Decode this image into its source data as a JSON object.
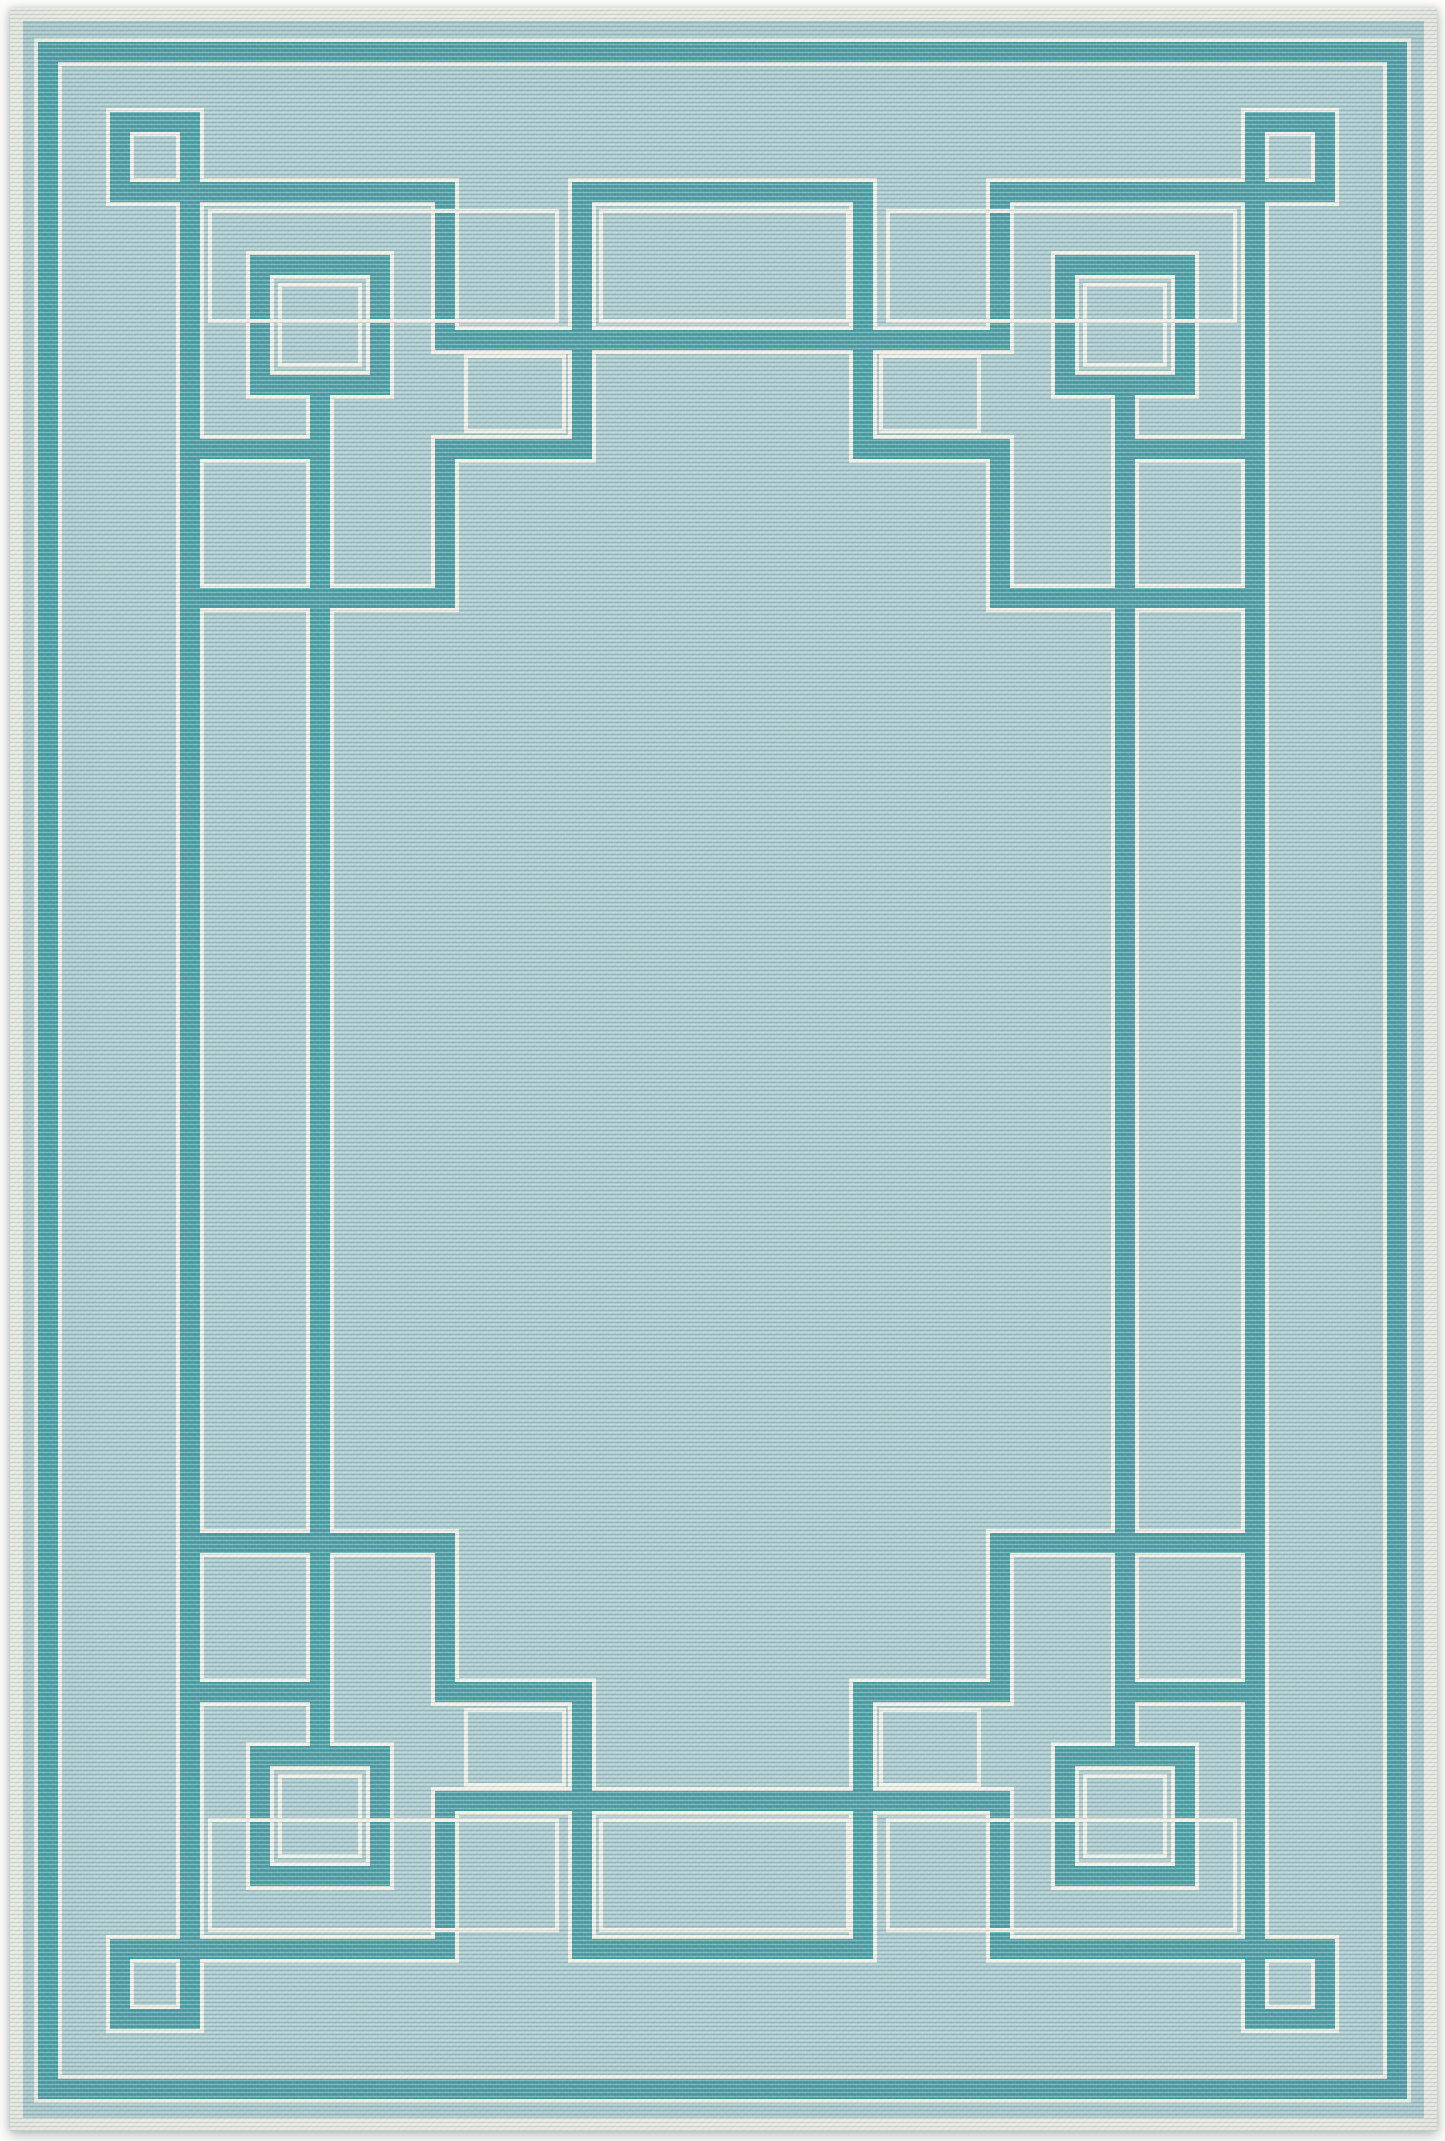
{
  "caption": "Product photograph of a portrait-oriented flat-weave area rug: light aqua ribbed field with a teal Art Deco interlocking square-and-meander border, every teal band outlined with ivory pinstripes, small and large nested squares in each corner, interlocking tab rectangles at top and bottom center, plain open center field, ivory bound edge, on a white background.",
  "object": {
    "type": "area rug",
    "orientation": "portrait",
    "weave": "ribbed loop flat-weave",
    "setting": "overhead product photo on white seamless background"
  },
  "pattern": {
    "name": "art-deco interlocking fret border",
    "elements": [
      "outer pinstriped teal frame line around perimeter",
      "small corner square rings",
      "large nested corner square rings with inner ivory echo square",
      "long inner rail lines running between top and bottom corner squares",
      "continuous meander with center tab rectangles at top and bottom",
      "main cross bar threading behind the tab verticals",
      "ivory echo outlines inside border pockets",
      "plain open center field"
    ]
  },
  "colors": {
    "background": "#fcfcfa",
    "binding_ivory": "#f1f0e7",
    "band_teal": "#4ba3a8",
    "field_aqua": "#abcbce",
    "rib_highlight": "rgba(255,255,255,0.26)",
    "rib_shadow": "rgba(25,65,75,0.15)",
    "drop_shadow": "rgba(110,125,125,0.40)"
  }
}
